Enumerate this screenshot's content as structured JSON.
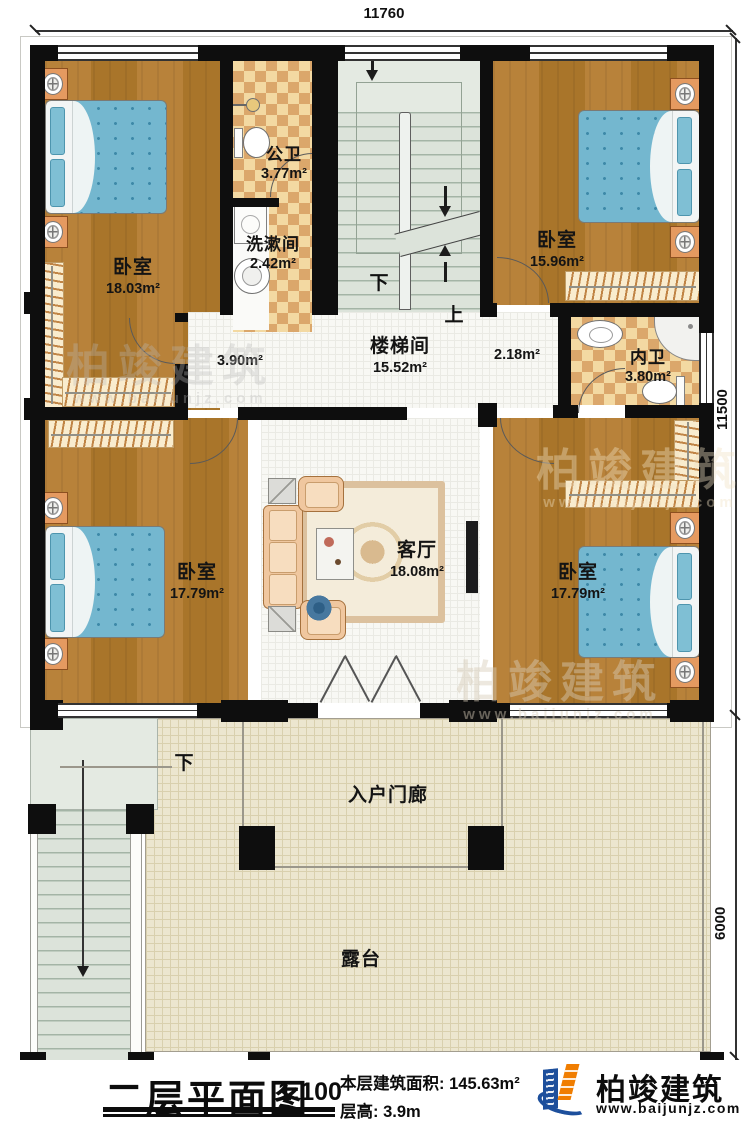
{
  "dimensions": {
    "width_top": "11760",
    "height_right_main": "11500",
    "height_right_terrace": "6000"
  },
  "rooms": {
    "bedroom_top_left": {
      "name": "卧室",
      "area": "18.03m²"
    },
    "bedroom_top_right": {
      "name": "卧室",
      "area": "15.96m²"
    },
    "bedroom_bottom_left": {
      "name": "卧室",
      "area": "17.79m²"
    },
    "bedroom_bottom_right": {
      "name": "卧室",
      "area": "17.79m²"
    },
    "public_bathroom": {
      "name": "公卫",
      "area": "3.77m²"
    },
    "washroom": {
      "name": "洗漱间",
      "area": "2.42m²"
    },
    "stair_hall": {
      "name": "楼梯间",
      "area": "15.52m²"
    },
    "hall_west_area": "3.90m²",
    "hall_east_area": "2.18m²",
    "ensuite_bathroom": {
      "name": "内卫",
      "area": "3.80m²"
    },
    "living_room": {
      "name": "客厅",
      "area": "18.08m²"
    },
    "entry_porch": {
      "name": "入户门廊"
    },
    "terrace": {
      "name": "露台"
    }
  },
  "stairs": {
    "down_label": "下",
    "up_label": "上",
    "porch_down_label": "下"
  },
  "title_block": {
    "title": "二层平面图",
    "scale": "1:100",
    "floor_area_label": "本层建筑面积:",
    "floor_area_value": "145.63m²",
    "floor_height_label": "层高:",
    "floor_height_value": "3.9m"
  },
  "brand": {
    "name": "柏竣建筑",
    "website": "www.baijunjz.com",
    "logo_blue": "#1d4f9c",
    "logo_orange": "#f07d00"
  },
  "watermark": {
    "name": "柏竣建筑",
    "website": "www.baijunjz.com"
  }
}
